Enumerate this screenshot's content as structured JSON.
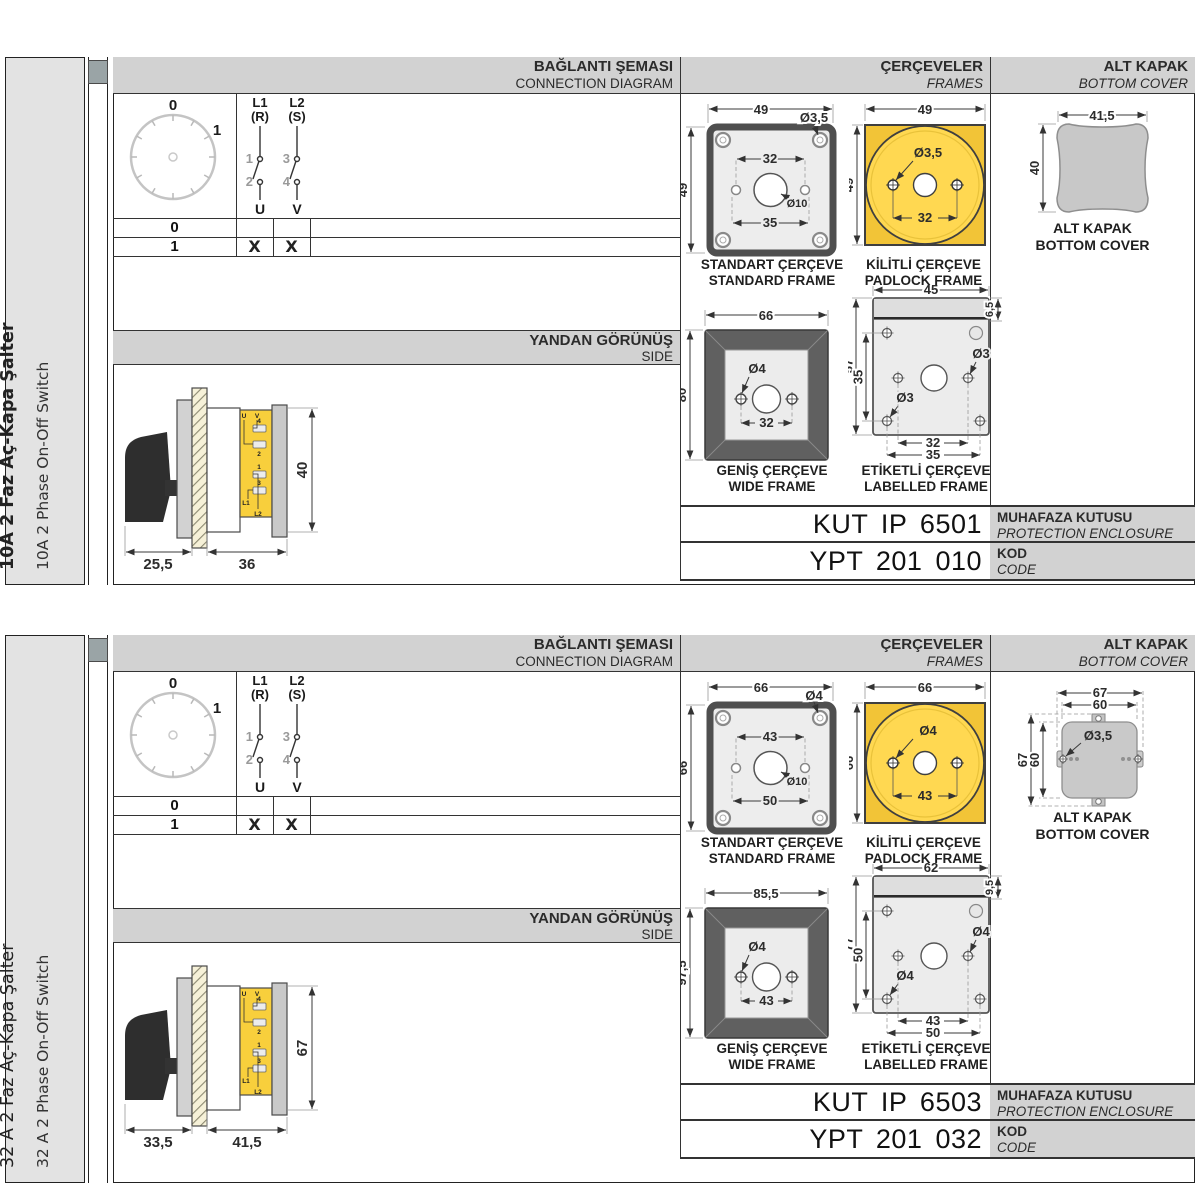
{
  "colors": {
    "accent_yellow": "#f2c437",
    "padlock_inner_yellow": "#ffd851",
    "header_gray": "#d2d2d2",
    "drawing_gray": "#ececec",
    "cover_gray": "#c8c8c8"
  },
  "panels": [
    {
      "side_label": {
        "title": "10A 2 Faz Aç-Kapa Şalter",
        "title_bold": true,
        "subtitle": "10A 2 Phase On-Off Switch"
      },
      "headers": {
        "connection": {
          "tr": "BAĞLANTI ŞEMASI",
          "en": "CONNECTION DIAGRAM"
        },
        "frames": {
          "tr": "ÇERÇEVELER",
          "en": "FRAMES"
        },
        "cover": {
          "tr": "ALT KAPAK",
          "en": "BOTTOM COVER"
        }
      },
      "dial": {
        "pos0": "0",
        "pos1": "1"
      },
      "contacts": {
        "c1": "L1",
        "c1b": "(R)",
        "c2": "L2",
        "c2b": "(S)",
        "n1": "1",
        "n2": "2",
        "n3": "3",
        "n4": "4",
        "u": "U",
        "v": "V"
      },
      "switch_table": {
        "rows": [
          {
            "label": "0",
            "u": "",
            "v": ""
          },
          {
            "label": "1",
            "u": "X",
            "v": "X"
          }
        ]
      },
      "side_view": {
        "header_tr": "YANDAN GÖRÜNÜŞ",
        "header_en": "SIDE",
        "dim_front": "25,5",
        "dim_body": "36",
        "dim_height": "40",
        "terminals": {
          "u": "U",
          "v": "V",
          "t4": "4",
          "t2": "2",
          "t1": "1",
          "t3": "3",
          "l1": "L1",
          "l2": "L2"
        }
      },
      "frames": {
        "standard": {
          "label_tr": "STANDART ÇERÇEVE",
          "label_en": "STANDARD FRAME",
          "width": "49",
          "height": "49",
          "hole": "Ø3,5",
          "inner": "32",
          "outer": "35",
          "center": "Ø10"
        },
        "padlock": {
          "label_tr": "KİLİTLİ ÇERÇEVE",
          "label_en": "PADLOCK FRAME",
          "width": "49",
          "height": "49",
          "hole": "Ø3,5",
          "inner": "32"
        },
        "wide": {
          "label_tr": "GENİŞ ÇERÇEVE",
          "label_en": "WIDE FRAME",
          "width": "66",
          "height": "80",
          "hole": "Ø4",
          "inner": "32"
        },
        "labelled": {
          "label_tr": "ETİKETLİ ÇERÇEVE",
          "label_en": "LABELLED FRAME",
          "width": "45",
          "strip": "6,5",
          "height": "57",
          "inner_h": "35",
          "hole_right": "Ø3",
          "hole_left": "Ø3",
          "inner": "32",
          "outer": "35"
        }
      },
      "cover": {
        "variant": "plain",
        "width": "41,5",
        "height": "40",
        "label_tr": "ALT KAPAK",
        "label_en": "BOTTOM COVER"
      },
      "codes": {
        "enclosure_value": "KUT IP 6501",
        "enclosure_tr": "MUHAFAZA KUTUSU",
        "enclosure_en": "PROTECTION ENCLOSURE",
        "code_value": "YPT 201 010",
        "code_tr": "KOD",
        "code_en": "CODE"
      }
    },
    {
      "side_label": {
        "title": "32 A 2 Faz Aç-Kapa Şalter",
        "title_bold": false,
        "subtitle": "32 A 2 Phase On-Off Switch"
      },
      "headers": {
        "connection": {
          "tr": "BAĞLANTI ŞEMASI",
          "en": "CONNECTION DIAGRAM"
        },
        "frames": {
          "tr": "ÇERÇEVELER",
          "en": "FRAMES"
        },
        "cover": {
          "tr": "ALT KAPAK",
          "en": "BOTTOM COVER"
        }
      },
      "dial": {
        "pos0": "0",
        "pos1": "1"
      },
      "contacts": {
        "c1": "L1",
        "c1b": "(R)",
        "c2": "L2",
        "c2b": "(S)",
        "n1": "1",
        "n2": "2",
        "n3": "3",
        "n4": "4",
        "u": "U",
        "v": "V"
      },
      "switch_table": {
        "rows": [
          {
            "label": "0",
            "u": "",
            "v": ""
          },
          {
            "label": "1",
            "u": "X",
            "v": "X"
          }
        ]
      },
      "side_view": {
        "header_tr": "YANDAN GÖRÜNÜŞ",
        "header_en": "SIDE",
        "dim_front": "33,5",
        "dim_body": "41,5",
        "dim_height": "67",
        "terminals": {
          "u": "U",
          "v": "V",
          "t4": "4",
          "t2": "2",
          "t1": "1",
          "t3": "3",
          "l1": "L1",
          "l2": "L2"
        }
      },
      "frames": {
        "standard": {
          "label_tr": "STANDART ÇERÇEVE",
          "label_en": "STANDARD FRAME",
          "width": "66",
          "height": "66",
          "hole": "Ø4",
          "inner": "43",
          "outer": "50",
          "center": "Ø10"
        },
        "padlock": {
          "label_tr": "KİLİTLİ ÇERÇEVE",
          "label_en": "PADLOCK FRAME",
          "width": "66",
          "height": "66",
          "hole": "Ø4",
          "inner": "43"
        },
        "wide": {
          "label_tr": "GENİŞ ÇERÇEVE",
          "label_en": "WIDE FRAME",
          "width": "85,5",
          "height": "97,5",
          "hole": "Ø4",
          "inner": "43"
        },
        "labelled": {
          "label_tr": "ETİKETLİ ÇERÇEVE",
          "label_en": "LABELLED FRAME",
          "width": "62",
          "strip": "9,5",
          "height": "77",
          "inner_h": "50",
          "hole_right": "Ø4",
          "hole_left": "Ø4",
          "inner": "43",
          "outer": "50"
        }
      },
      "cover": {
        "variant": "tabbed",
        "outer_w": "67",
        "inner_w": "60",
        "outer_h": "67",
        "inner_h": "60",
        "hole": "Ø3,5",
        "label_tr": "ALT KAPAK",
        "label_en": "BOTTOM COVER"
      },
      "codes": {
        "enclosure_value": "KUT IP 6503",
        "enclosure_tr": "MUHAFAZA KUTUSU",
        "enclosure_en": "PROTECTION ENCLOSURE",
        "code_value": "YPT 201 032",
        "code_tr": "KOD",
        "code_en": "CODE"
      }
    }
  ]
}
